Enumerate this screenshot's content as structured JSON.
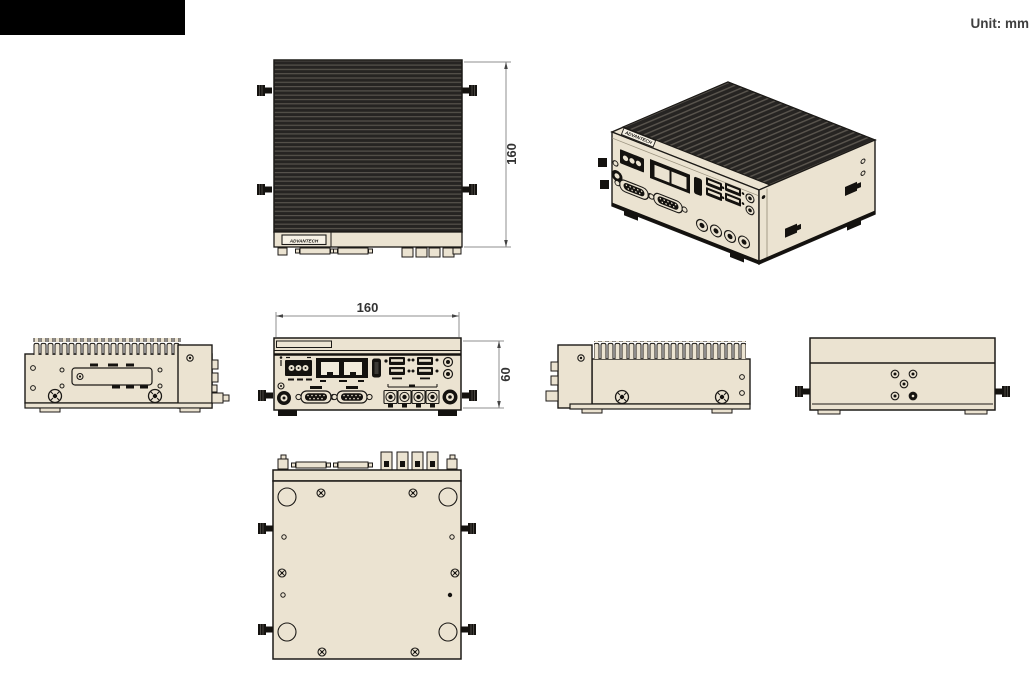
{
  "header": {
    "unit_label": "Unit: mm"
  },
  "brand": {
    "logo_text": "ADVANTECH"
  },
  "dimensions": {
    "top_view_height_mm": "160",
    "front_view_width_mm": "160",
    "front_view_height_mm": "60"
  },
  "palette": {
    "body": "#ebe3d1",
    "outline": "#1c1a17",
    "fin_dark": "#262422",
    "fin_light": "#57534c",
    "dim_line": "#8f8f8f",
    "dim_text": "#333333",
    "redaction": "#000000"
  }
}
